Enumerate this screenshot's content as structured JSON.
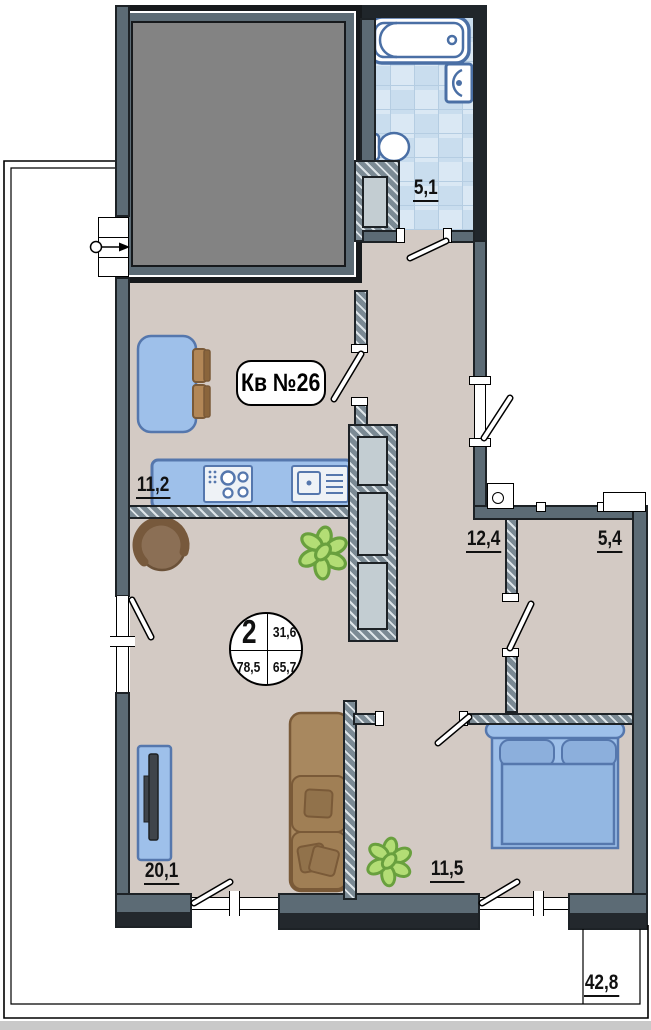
{
  "plan": {
    "badge": "Кв №26",
    "info_circle": {
      "rooms": "2",
      "top_right": "31,6",
      "bottom_left": "78,5",
      "bottom_right": "65,7"
    },
    "rooms": [
      {
        "name": "bathroom",
        "area": "5,1"
      },
      {
        "name": "kitchen",
        "area": "11,2"
      },
      {
        "name": "hallway",
        "area": "12,4"
      },
      {
        "name": "wardrobe",
        "area": "5,4"
      },
      {
        "name": "living-room",
        "area": "20,1"
      },
      {
        "name": "bedroom",
        "area": "11,5"
      },
      {
        "name": "terrace",
        "area": "42,8"
      }
    ],
    "colors": {
      "floor": "#d3cac4",
      "wall_slate": "#5c6b75",
      "wall_dark": "#20262b",
      "tile_blue": "#cfe1f0",
      "furniture_blue": "#9ec0ea",
      "furniture_blue_stroke": "#5577ad",
      "sofa_brown": "#a8885f",
      "plant_green": "#b3dd75"
    }
  }
}
